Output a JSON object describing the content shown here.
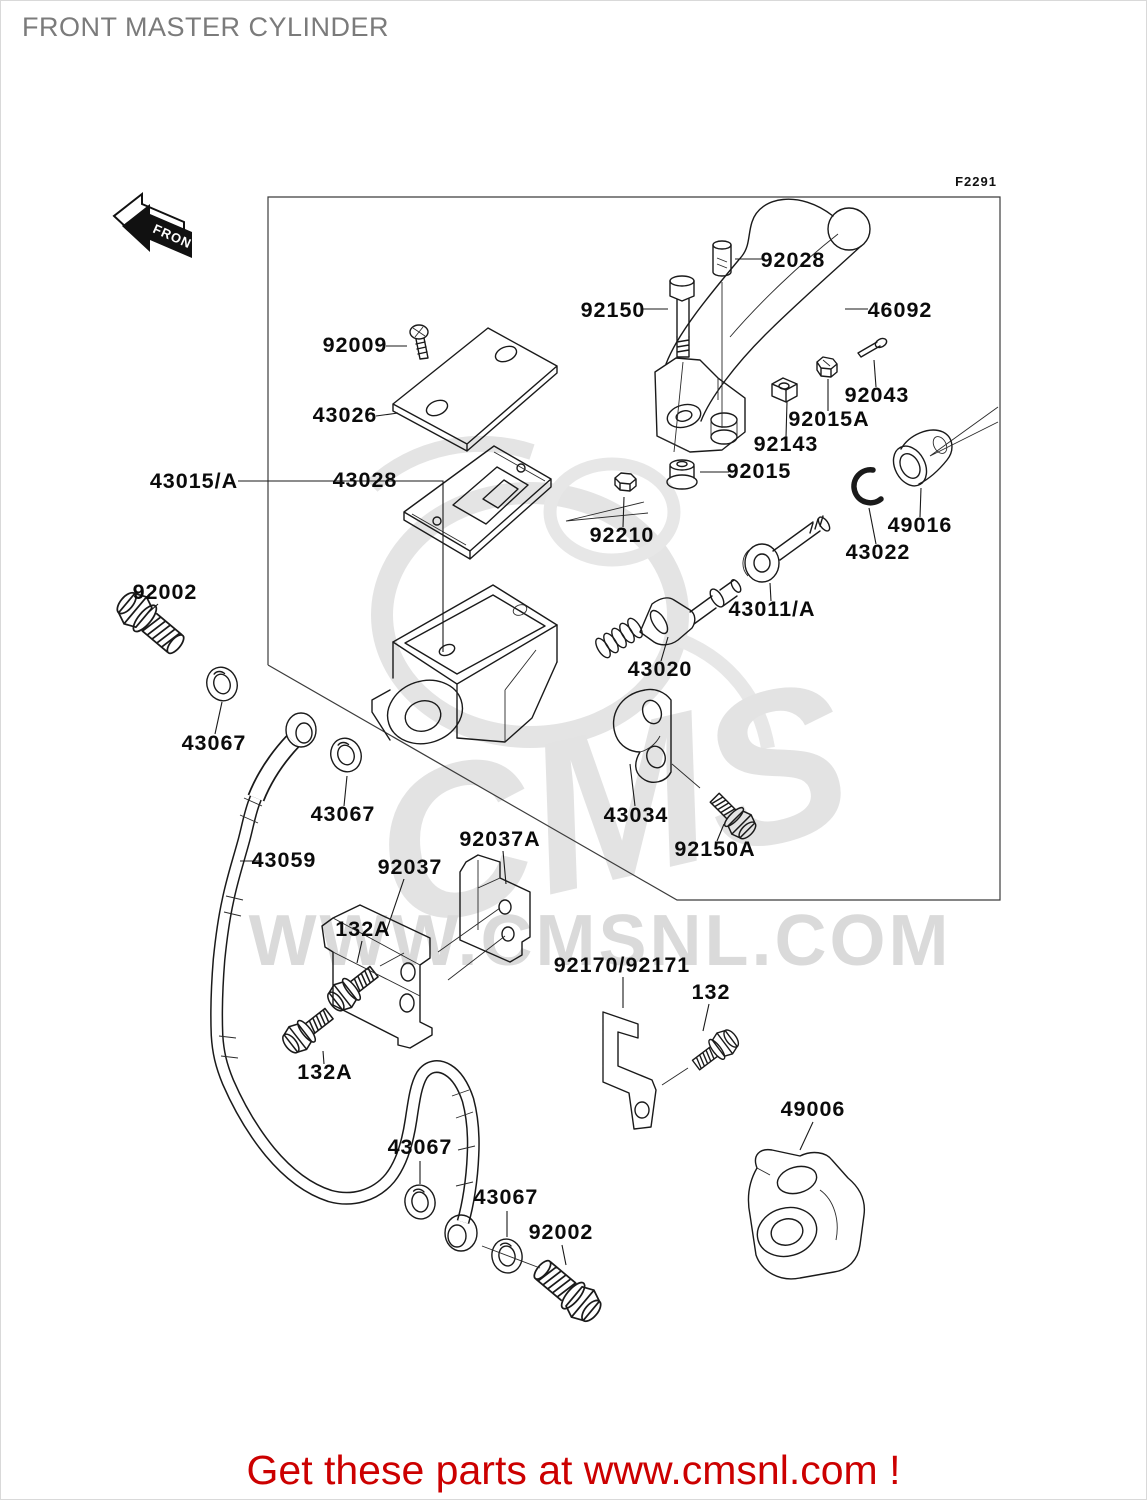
{
  "page": {
    "title": "FRONT MASTER CYLINDER",
    "figure_code": "F2291",
    "front_marker": "FRONT",
    "banner": "Get these parts at www.cmsnl.com !"
  },
  "watermark": {
    "cms": "CMS",
    "url": "WWW.CMSNL.COM"
  },
  "colors": {
    "banner_red": "#cc0000",
    "title_gray": "#7b7b7b",
    "line_black": "#1a1a1a",
    "watermark_gray": "#d8d8d8"
  },
  "diagram": {
    "labels": [
      {
        "text": "92028"
      },
      {
        "text": "92150"
      },
      {
        "text": "46092"
      },
      {
        "text": "92043"
      },
      {
        "text": "92015A"
      },
      {
        "text": "92143"
      },
      {
        "text": "92009"
      },
      {
        "text": "43026"
      },
      {
        "text": "43028"
      },
      {
        "text": "43015/A"
      },
      {
        "text": "92210"
      },
      {
        "text": "92015"
      },
      {
        "text": "49016"
      },
      {
        "text": "43022"
      },
      {
        "text": "43011/A"
      },
      {
        "text": "43020"
      },
      {
        "text": "92002"
      },
      {
        "text": "43067"
      },
      {
        "text": "43067"
      },
      {
        "text": "43059"
      },
      {
        "text": "92037"
      },
      {
        "text": "92037A"
      },
      {
        "text": "132A"
      },
      {
        "text": "43034"
      },
      {
        "text": "92150A"
      },
      {
        "text": "92170/92171"
      },
      {
        "text": "132"
      },
      {
        "text": "132A"
      },
      {
        "text": "43067"
      },
      {
        "text": "43067"
      },
      {
        "text": "92002"
      },
      {
        "text": "49006"
      }
    ]
  }
}
